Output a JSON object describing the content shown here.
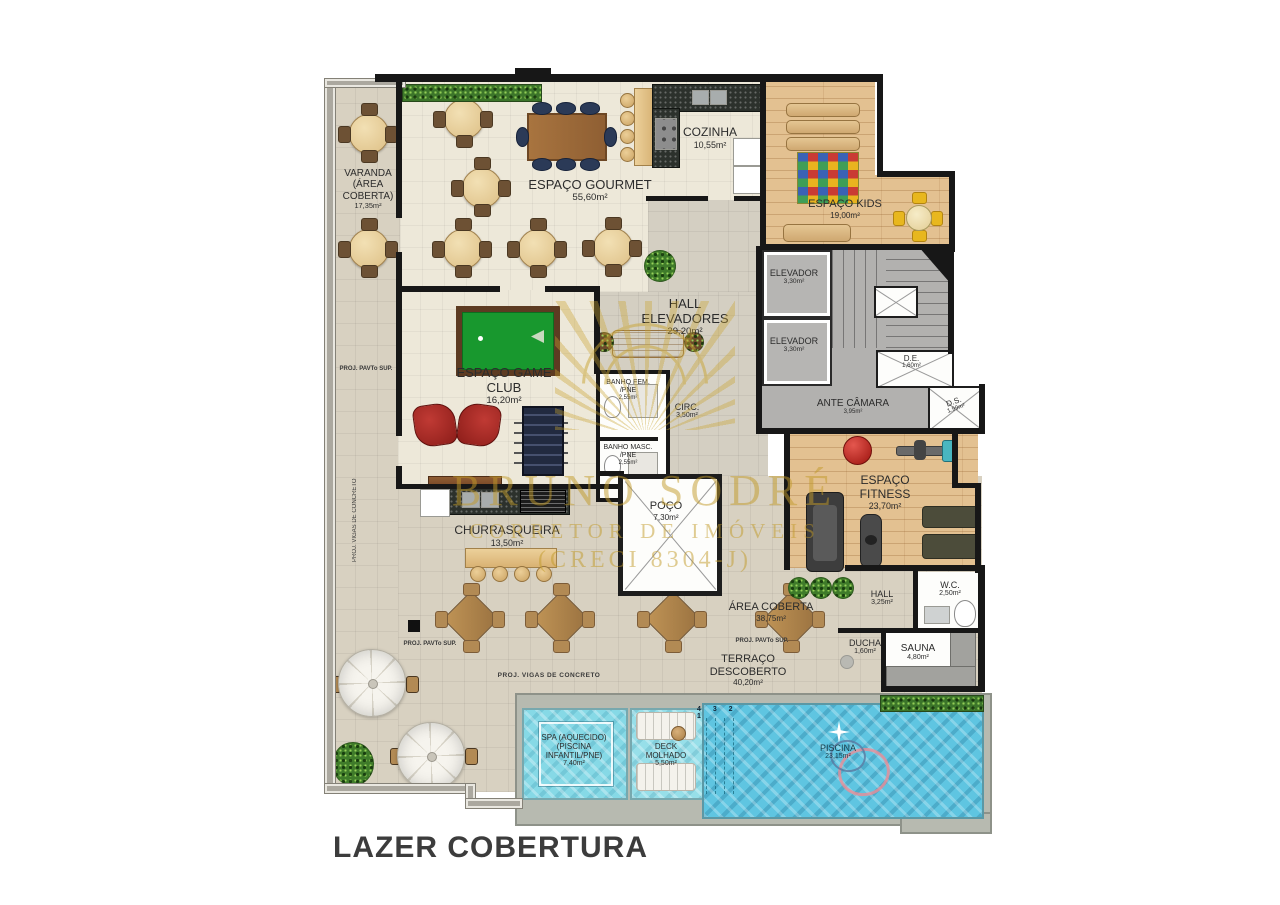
{
  "title": "LAZER COBERTURA",
  "watermark": {
    "line1": "BRUNO SODRÉ",
    "line2": "CORRETOR DE IMÓVEIS",
    "line3": "(CRECI 8304-J)",
    "color": "#c29b2a"
  },
  "rooms": {
    "varanda": {
      "name": "VARANDA (ÁREA COBERTA)",
      "area": "17,35m²"
    },
    "gourmet": {
      "name": "ESPAÇO GOURMET",
      "area": "55,60m²"
    },
    "cozinha": {
      "name": "COZINHA",
      "area": "10,55m²"
    },
    "kids": {
      "name": "ESPAÇO KIDS",
      "area": "19,00m²"
    },
    "elevador1": {
      "name": "ELEVADOR",
      "area": "3,30m²"
    },
    "elevador2": {
      "name": "ELEVADOR",
      "area": "3,30m²"
    },
    "hall_elevadores": {
      "name": "HALL ELEVADORES",
      "area": "29,20m²"
    },
    "ante_camara": {
      "name": "ANTE CÂMARA",
      "area": "3,95m²"
    },
    "de": {
      "name": "D.E.",
      "area": "1,60m²"
    },
    "ds": {
      "name": "D.S.",
      "area": "1,99m²"
    },
    "game_club": {
      "name": "ESPAÇO GAME CLUB",
      "area": "16,20m²"
    },
    "banho_fem": {
      "name": "BANHO FEM. /PNE",
      "area": "2,55m²"
    },
    "circ": {
      "name": "CIRC.",
      "area": "3,50m²"
    },
    "banho_masc": {
      "name": "BANHO MASC. /PNE",
      "area": "2,55m²"
    },
    "churrasqueira": {
      "name": "CHURRASQUEIRA",
      "area": "13,50m²"
    },
    "poco": {
      "name": "POÇO",
      "area": "7,30m²"
    },
    "fitness": {
      "name": "ESPAÇO FITNESS",
      "area": "23,70m²"
    },
    "area_coberta": {
      "name": "ÁREA COBERTA",
      "area": "38,75m²"
    },
    "hall": {
      "name": "HALL",
      "area": "3,25m²"
    },
    "wc": {
      "name": "W.C.",
      "area": "2,50m²"
    },
    "ducha": {
      "name": "DUCHA",
      "area": "1,60m²"
    },
    "sauna": {
      "name": "SAUNA",
      "area": "4,80m²"
    },
    "terraco": {
      "name": "TERRAÇO DESCOBERTO",
      "area": "40,20m²"
    },
    "spa": {
      "name": "SPA (AQUECIDO) (PISCINA INFANTIL/PNE)",
      "area": "7,40m²"
    },
    "deck_molhado": {
      "name": "DECK MOLHADO",
      "area": "5,50m²"
    },
    "piscina": {
      "name": "PISCINA",
      "area": "23,15m²"
    }
  },
  "annotations": {
    "proj_pavto": "PROJ. PAVTo SUP.",
    "proj_vigas": "PROJ. VIGAS DE CONCRETO",
    "pool_steps": "4 3 2 1"
  },
  "colors": {
    "wall": "#171717",
    "floor_cream": "#ede8d9",
    "floor_tan": "#d8d1c1",
    "floor_wood": "#e3c191",
    "floor_gray": "#b2b1af",
    "water_spa": "#86d9e6",
    "water_pool": "#5fc5e1",
    "hedge": "#3c752a",
    "pool_table_felt": "#18982e",
    "armchair_red": "#a32421",
    "watermark_gold": "#c9a432"
  }
}
